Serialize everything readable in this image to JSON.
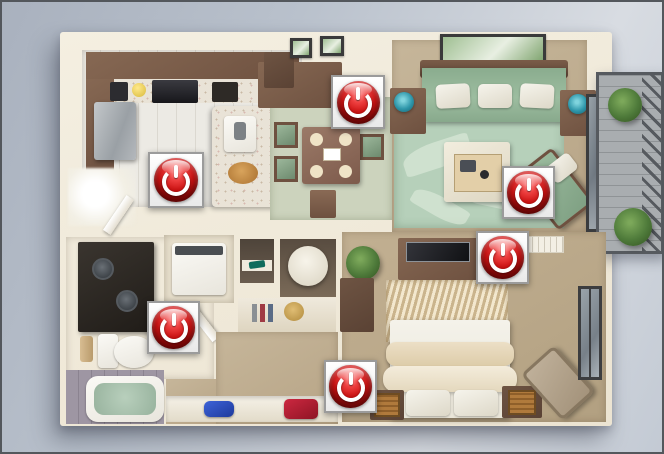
{
  "colors": {
    "accent_red": "#c71414",
    "button_box_fill": "#ffffff",
    "button_box_border": "#9b9b9b",
    "background_top_left": "#a9b1be",
    "background_bottom_right": "#d8dce2",
    "wall_cream": "#f0e9d9",
    "sofa_green": "#9dbda0",
    "rug_green": "#b6d0ba",
    "floor_tan": "#bcab8d",
    "tub_water_green": "#a9c2ae"
  },
  "icons": {
    "power": "power-icon"
  },
  "power_buttons": [
    {
      "room": "kitchen",
      "x": 146,
      "y": 150,
      "size": 56
    },
    {
      "room": "dining-area",
      "x": 329,
      "y": 73,
      "size": 54
    },
    {
      "room": "living-room",
      "x": 500,
      "y": 164,
      "size": 53
    },
    {
      "room": "bedroom",
      "x": 474,
      "y": 229,
      "size": 53
    },
    {
      "room": "bathroom",
      "x": 145,
      "y": 299,
      "size": 53
    },
    {
      "room": "hallway",
      "x": 322,
      "y": 358,
      "size": 53
    }
  ]
}
